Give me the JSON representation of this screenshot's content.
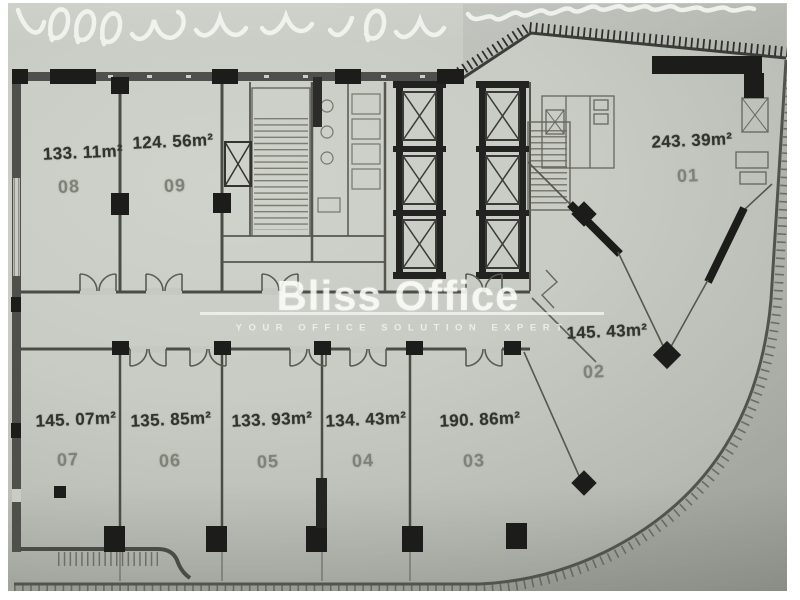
{
  "watermark": {
    "brand": "Bliss Office",
    "tagline": "YOUR OFFICE SOLUTION EXPERT"
  },
  "units": [
    {
      "no": "01",
      "area": "243. 39m²"
    },
    {
      "no": "02",
      "area": "145. 43m²"
    },
    {
      "no": "03",
      "area": "190. 86m²"
    },
    {
      "no": "04",
      "area": "134. 43m²"
    },
    {
      "no": "05",
      "area": "133. 93m²"
    },
    {
      "no": "06",
      "area": "135. 85m²"
    },
    {
      "no": "07",
      "area": "145. 07m²"
    },
    {
      "no": "08",
      "area": "133. 11m²"
    },
    {
      "no": "09",
      "area": "124. 56m²"
    }
  ]
}
